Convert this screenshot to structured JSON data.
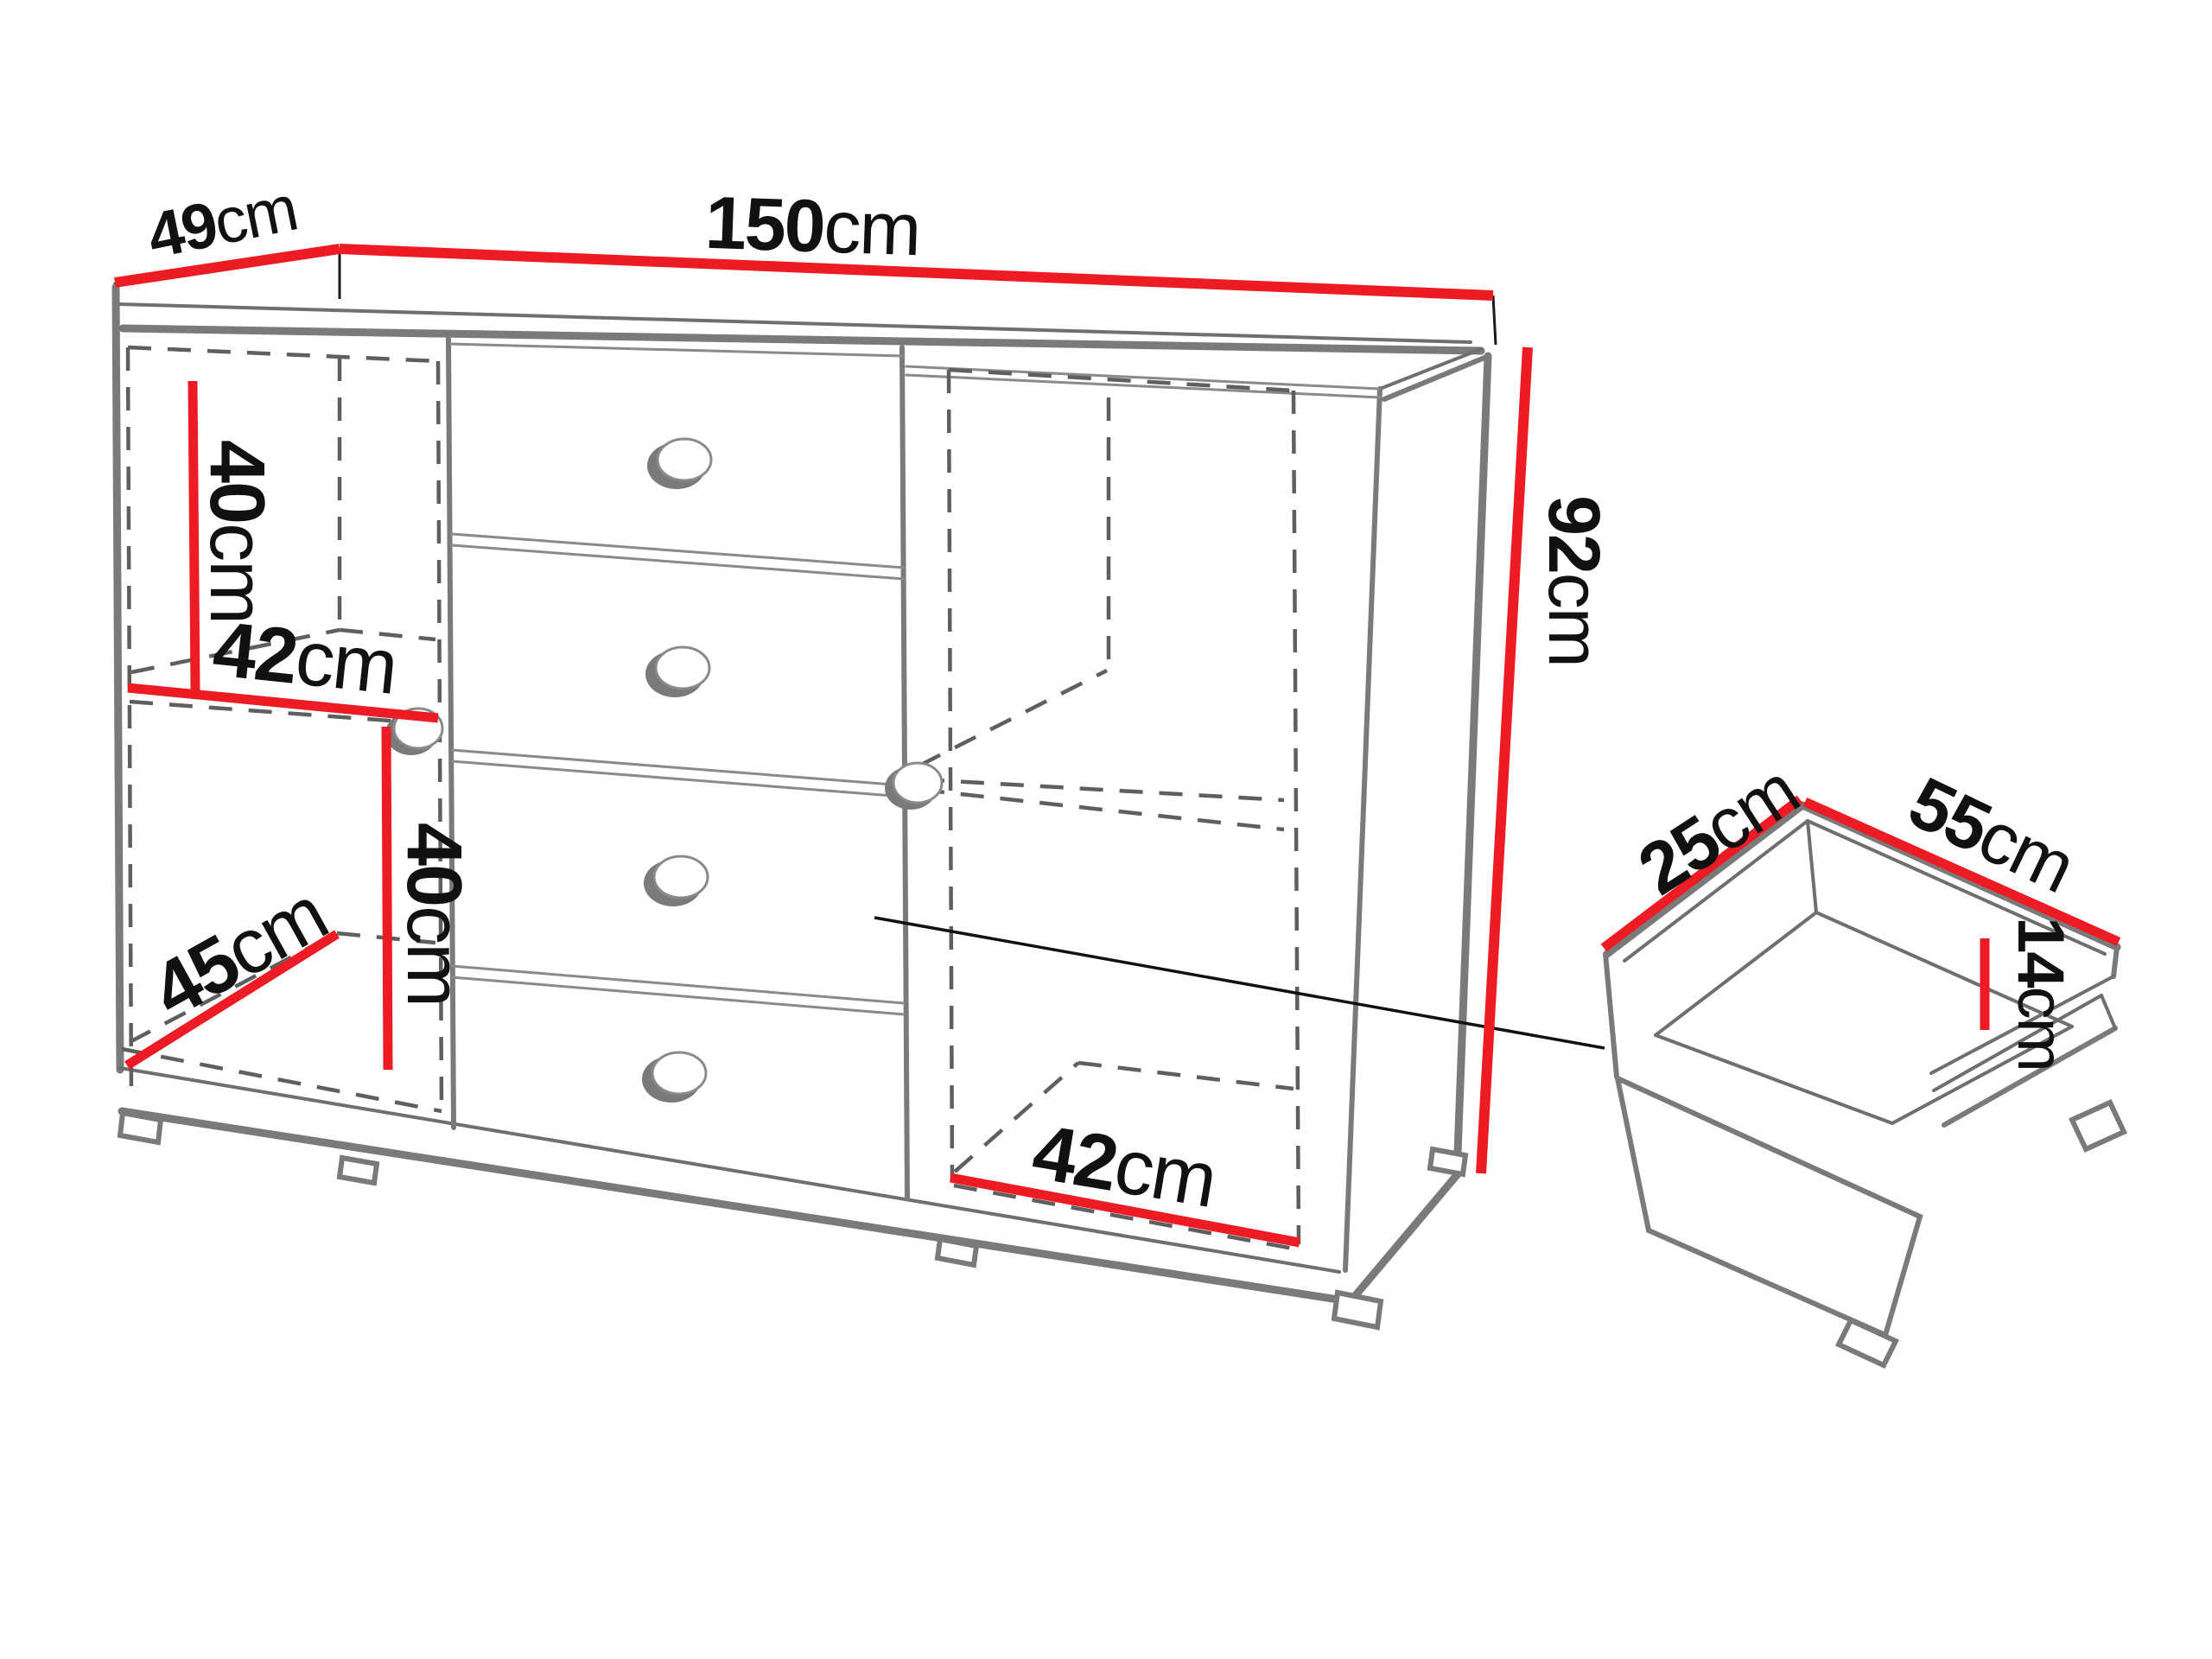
{
  "diagram": {
    "type": "furniture-dimension-drawing",
    "accent_color": "#ED1C24",
    "line_color": "#7a7a7a",
    "text_color": "#111111"
  },
  "cabinet": {
    "doors": 2,
    "drawer_count": 4,
    "width": {
      "value": "150",
      "unit": "cm"
    },
    "depth": {
      "value": "49",
      "unit": "cm"
    },
    "height": {
      "value": "92",
      "unit": "cm"
    },
    "left_upper_compartment_height": {
      "value": "40",
      "unit": "cm"
    },
    "left_shelf_width": {
      "value": "42",
      "unit": "cm"
    },
    "left_lower_compartment_height": {
      "value": "40",
      "unit": "cm"
    },
    "left_compartment_depth": {
      "value": "45",
      "unit": "cm"
    },
    "right_compartment_width": {
      "value": "42",
      "unit": "cm"
    }
  },
  "drawer_inset": {
    "depth": {
      "value": "25",
      "unit": "cm"
    },
    "width": {
      "value": "55",
      "unit": "cm"
    },
    "height": {
      "value": "14",
      "unit": "cm"
    }
  }
}
